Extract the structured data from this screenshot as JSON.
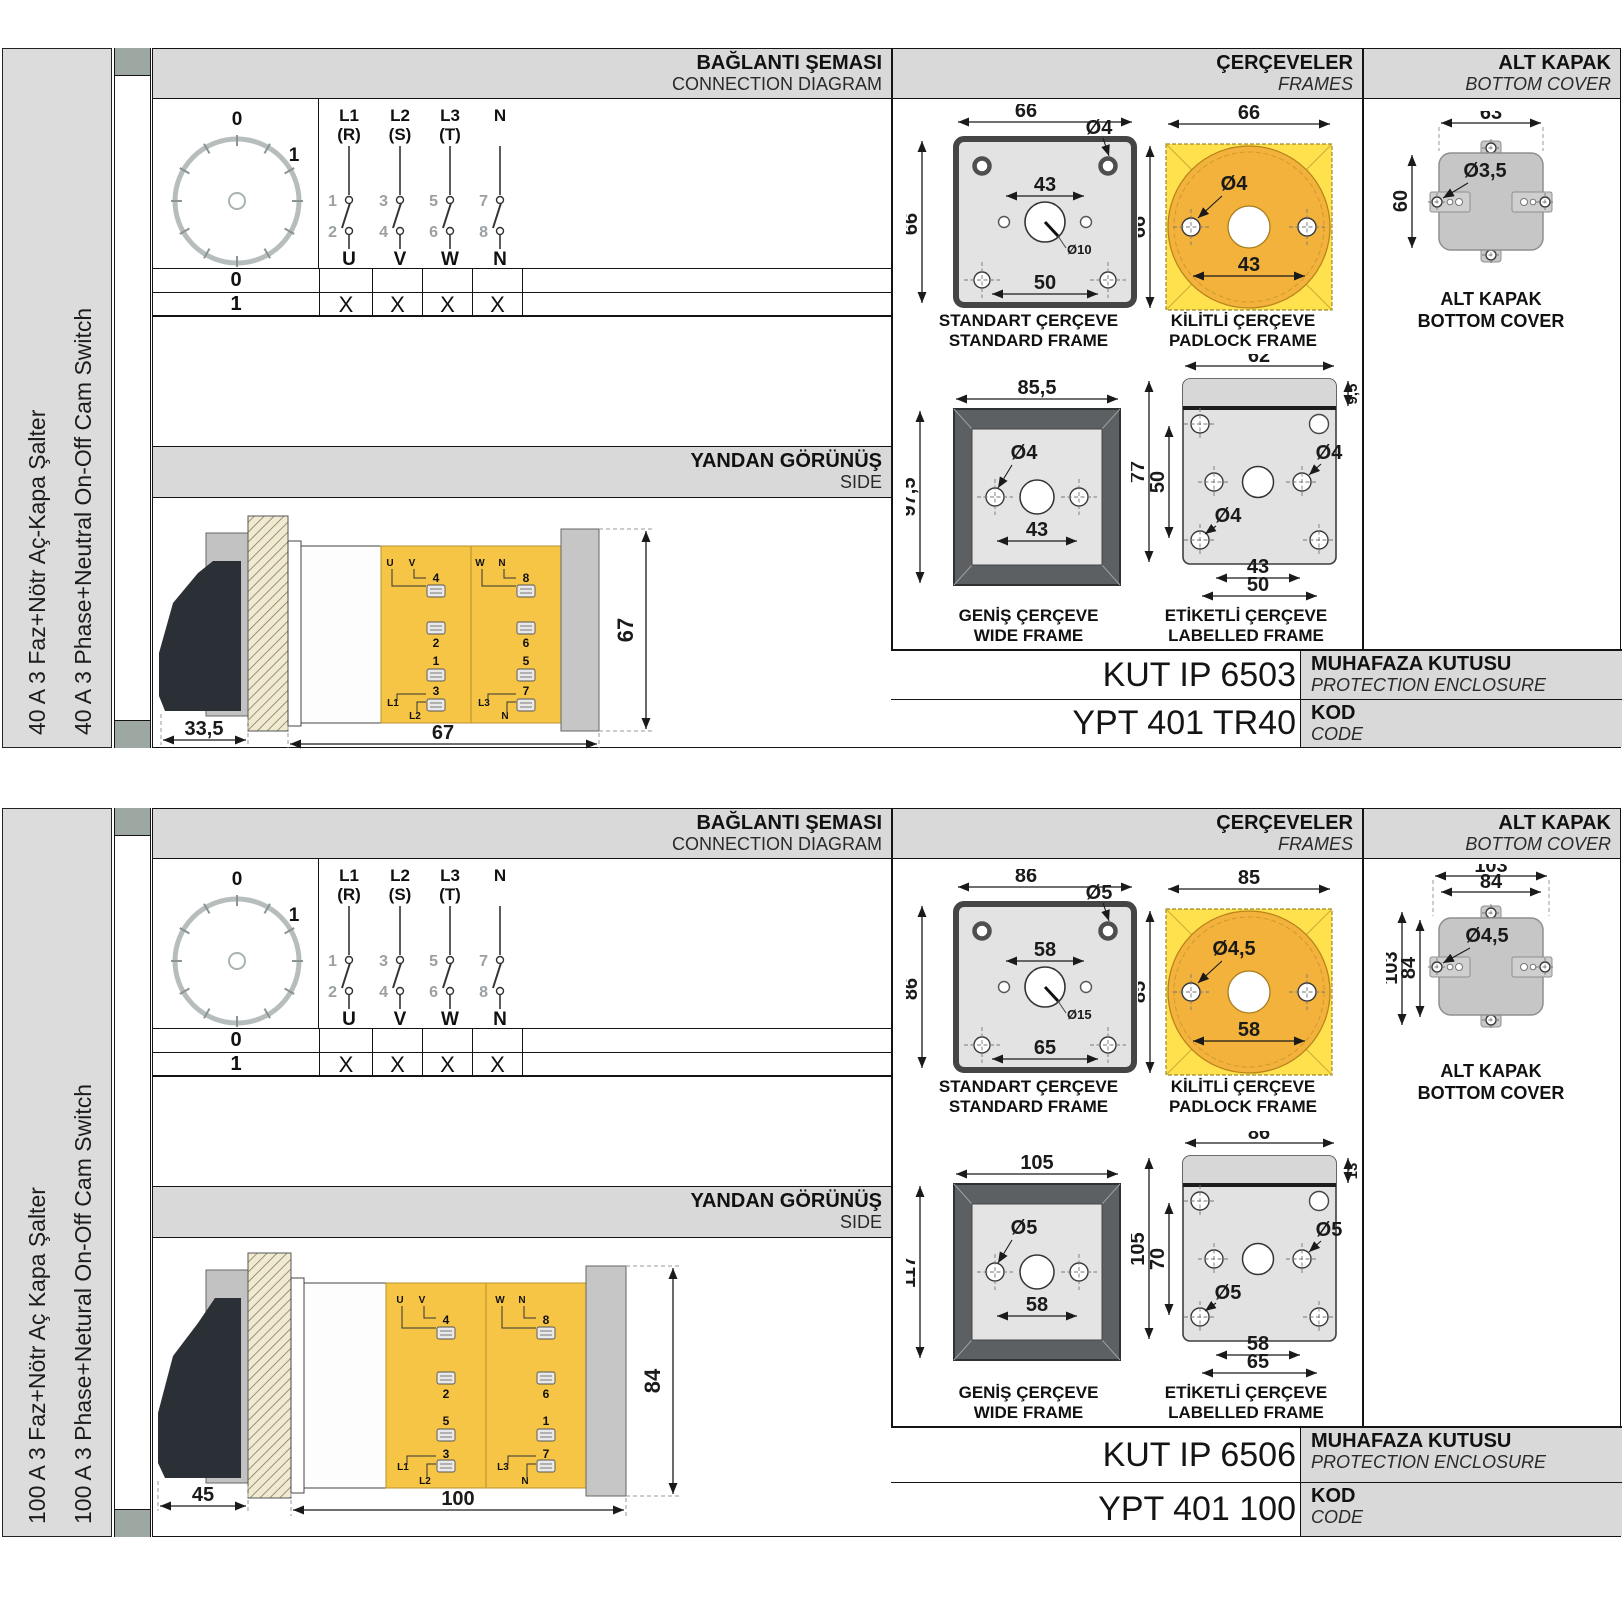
{
  "sections": [
    {
      "side_tr": "40 A 3 Faz+Nötr Aç-Kapa Şalter",
      "side_en": "40 A 3 Phase+Neutral On-Off Cam Switch",
      "hdr": {
        "conn_tr": "BAĞLANTI ŞEMASI",
        "conn_en": "CONNECTION DIAGRAM",
        "frames_tr": "ÇERÇEVELER",
        "frames_en": "FRAMES",
        "cover_tr": "ALT KAPAK",
        "cover_en": "BOTTOM COVER",
        "side_tr": "YANDAN GÖRÜNÜŞ",
        "side_en": "SIDE"
      },
      "dial": {
        "p0": "0",
        "p1": "1"
      },
      "phases": [
        {
          "t": "L1",
          "s": "(R)",
          "a": "1",
          "b": "2",
          "u": "U"
        },
        {
          "t": "L2",
          "s": "(S)",
          "a": "3",
          "b": "4",
          "u": "V"
        },
        {
          "t": "L3",
          "s": "(T)",
          "a": "5",
          "b": "6",
          "u": "W"
        },
        {
          "t": "N",
          "s": "",
          "a": "7",
          "b": "8",
          "u": "N"
        }
      ],
      "rows": [
        {
          "label": "0",
          "c1": "",
          "c2": "",
          "c3": "",
          "c4": ""
        },
        {
          "label": "1",
          "c1": "X",
          "c2": "X",
          "c3": "X",
          "c4": "X"
        }
      ],
      "side": {
        "d_handle": "33,5",
        "d_depth": "67",
        "d_height": "67"
      },
      "terms": {
        "ul1": "U",
        "ul2": "V",
        "t4": "4",
        "t2": "2",
        "t1": "1",
        "t3": "3",
        "bl1": "L1",
        "bl2": "L2",
        "ur1": "W",
        "ur2": "N",
        "t8": "8",
        "t6": "6",
        "t5": "5",
        "t7": "7",
        "br1": "L3",
        "br2": "N"
      },
      "std": {
        "cap_tr": "STANDART ÇERÇEVE",
        "cap_en": "STANDARD FRAME",
        "w": "66",
        "h": "66",
        "hole": "Ø4",
        "span": "43",
        "center": "Ø10",
        "span2": "50"
      },
      "pad": {
        "cap_tr": "KİLİTLİ ÇERÇEVE",
        "cap_en": "PADLOCK FRAME",
        "w": "66",
        "h": "66",
        "hole": "Ø4",
        "span": "43"
      },
      "wide": {
        "cap_tr": "GENİŞ ÇERÇEVE",
        "cap_en": "WIDE FRAME",
        "w": "85,5",
        "h": "97,5",
        "hole": "Ø4",
        "span": "43"
      },
      "lab": {
        "cap_tr": "ETİKETLİ ÇERÇEVE",
        "cap_en": "LABELLED FRAME",
        "w": "62",
        "strip": "9,5",
        "h": "77",
        "vspan": "50",
        "hole": "Ø4",
        "hole2": "Ø4",
        "span": "43",
        "span2": "50"
      },
      "cover": {
        "cap_tr": "ALT KAPAK",
        "cap_en": "BOTTOM COVER",
        "w": "63",
        "h": "60",
        "hole": "Ø3,5"
      },
      "enc": {
        "value": "KUT IP 6503",
        "tr": "MUHAFAZA KUTUSU",
        "en": "PROTECTION ENCLOSURE"
      },
      "code": {
        "value": "YPT 401 TR40",
        "tr": "KOD",
        "en": "CODE"
      }
    },
    {
      "side_tr": "100 A 3 Faz+Nötr Aç Kapa Şalter",
      "side_en": "100 A 3 Phase+Netural On-Off Cam Switch",
      "hdr": {
        "conn_tr": "BAĞLANTI ŞEMASI",
        "conn_en": "CONNECTION DIAGRAM",
        "frames_tr": "ÇERÇEVELER",
        "frames_en": "FRAMES",
        "cover_tr": "ALT KAPAK",
        "cover_en": "BOTTOM COVER",
        "side_tr": "YANDAN GÖRÜNÜŞ",
        "side_en": "SIDE"
      },
      "dial": {
        "p0": "0",
        "p1": "1"
      },
      "phases": [
        {
          "t": "L1",
          "s": "(R)",
          "a": "1",
          "b": "2",
          "u": "U"
        },
        {
          "t": "L2",
          "s": "(S)",
          "a": "3",
          "b": "4",
          "u": "V"
        },
        {
          "t": "L3",
          "s": "(T)",
          "a": "5",
          "b": "6",
          "u": "W"
        },
        {
          "t": "N",
          "s": "",
          "a": "7",
          "b": "8",
          "u": "N"
        }
      ],
      "rows": [
        {
          "label": "0",
          "c1": "",
          "c2": "",
          "c3": "",
          "c4": ""
        },
        {
          "label": "1",
          "c1": "X",
          "c2": "X",
          "c3": "X",
          "c4": "X"
        }
      ],
      "side": {
        "d_handle": "45",
        "d_depth": "100",
        "d_height": "84"
      },
      "terms": {
        "ul1": "U",
        "ul2": "V",
        "t4": "4",
        "t2": "2",
        "t1": "1",
        "t3": "3",
        "bl1": "L1",
        "bl2": "L2",
        "ur1": "W",
        "ur2": "N",
        "t8": "8",
        "t6": "6",
        "t5": "5",
        "t7": "7",
        "br1": "L3",
        "br2": "N"
      },
      "std": {
        "cap_tr": "STANDART ÇERÇEVE",
        "cap_en": "STANDARD FRAME",
        "w": "86",
        "h": "86",
        "hole": "Ø5",
        "span": "58",
        "center": "Ø15",
        "span2": "65"
      },
      "pad": {
        "cap_tr": "KİLİTLİ ÇERÇEVE",
        "cap_en": "PADLOCK FRAME",
        "w": "85",
        "h": "85",
        "hole": "Ø4,5",
        "span": "58"
      },
      "wide": {
        "cap_tr": "GENİŞ ÇERÇEVE",
        "cap_en": "WIDE FRAME",
        "w": "105",
        "h": "117",
        "hole": "Ø5",
        "span": "58"
      },
      "lab": {
        "cap_tr": "ETİKETLİ ÇERÇEVE",
        "cap_en": "LABELLED FRAME",
        "w": "86",
        "strip": "13",
        "h": "105",
        "vspan": "70",
        "hole": "Ø5",
        "hole2": "Ø5",
        "span": "58",
        "span2": "65"
      },
      "cover": {
        "cap_tr": "ALT KAPAK",
        "cap_en": "BOTTOM COVER",
        "w": "103",
        "w2": "84",
        "h": "103",
        "h2": "84",
        "hole": "Ø4,5"
      },
      "enc": {
        "value": "KUT IP 6506",
        "tr": "MUHAFAZA KUTUSU",
        "en": "PROTECTION ENCLOSURE"
      },
      "code": {
        "value": "YPT 401 100",
        "tr": "KOD",
        "en": "CODE"
      }
    }
  ]
}
